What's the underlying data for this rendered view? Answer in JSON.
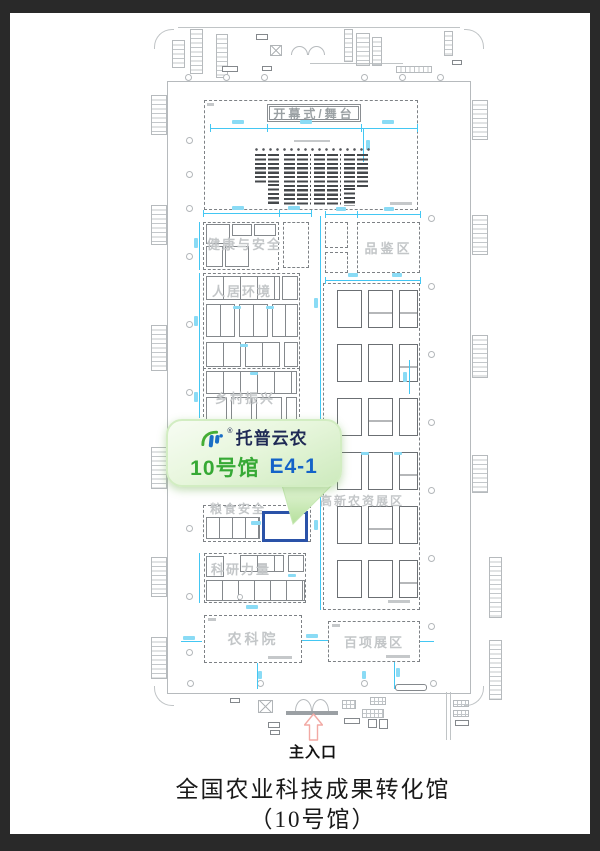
{
  "callout": {
    "brand": "托普云农",
    "reg": "®",
    "hall": "10号馆",
    "booth": "E4-1"
  },
  "plan": {
    "stage": "开幕式/舞台",
    "zones": {
      "health": "健康与安全",
      "tasting": "品鉴区",
      "living": "人居环境",
      "rural": "乡村振兴",
      "grain": "粮食安全",
      "research": "科研力量",
      "academy": "农科院",
      "hightech": "高新农资展区",
      "hundred": "百项展区"
    },
    "entrance": "主入口"
  },
  "footer": {
    "line1": "全国农业科技成果转化馆",
    "line2": "（10号馆）"
  },
  "icons": {
    "tp-logo-icon": "TP",
    "up-arrow-icon": "⇧"
  },
  "colors": {
    "frame_bg": "#292929",
    "paper_bg": "#ffffff",
    "plan_line_gray": "#b6babd",
    "booth_line_gray": "#6b6f73",
    "zone_label_gray": "#c3c6c8",
    "dimension_cyan": "#43c7f3",
    "seat_dark": "#46494c",
    "highlight_booth_blue": "#2a52a8",
    "entrance_arrow_pink": "#f2a9a4",
    "callout_green_light": "#f7fcf3",
    "callout_green_dark": "#cdeabd",
    "hall_text_green": "#36a935",
    "booth_text_blue": "#1463c8",
    "brand_text_navy": "#1f2a55"
  }
}
